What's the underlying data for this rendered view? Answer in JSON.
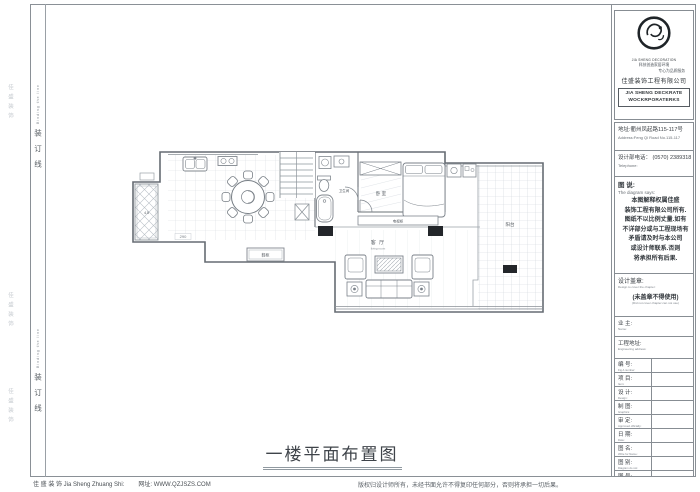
{
  "sheet": {
    "drawing_title": "一楼平面布置图"
  },
  "binding": {
    "cn": "装订线",
    "en": "Binding the line"
  },
  "side_marks": {
    "m1": "佳盛装饰",
    "m2": "佳盛装饰",
    "m3": "佳盛装饰"
  },
  "title_block": {
    "logo": {
      "caption": "JIA SHENG DECORATION",
      "slogan1": "科技创造家居环境",
      "slogan2": "专心为品质服务",
      "company": "佳盛装饰工程有限公司",
      "name_en1": "JIA SHENG DECKRATE",
      "name_en2": "WOCKRPORATERKS"
    },
    "address_cn": "地址:衢州凤起路115-117号",
    "address_en": "Address:Feng Qi Road No.115-117",
    "phone_cn": "设计部电话： (0570) 2389318",
    "phone_en": "Telephone:",
    "notes_cn": "图 说:",
    "notes_en": "The diagram says:",
    "notes_body": "本图解释权属佳盛\n装饰工程有限公司所有.\n图纸不以比例丈量.如有\n不详部分或与工程现场有\n矛盾请及时与本公司\n或设计师联系.否则\n将承担所有后果.",
    "seal_cn": "设计盖章:",
    "seal_en": "Design to cover the chapter:",
    "seal_warn_cn": "(未盖章不得使用)",
    "seal_warn_en": "(Did not cover chapter can not use)",
    "owner_cn": "业 主:",
    "owner_en": "Name:",
    "site_cn": "工程地址:",
    "site_en": "Engineering address:",
    "rows": [
      {
        "cn": "编 号:",
        "en": "Fig A number:"
      },
      {
        "cn": "项 目:",
        "en": "Item:"
      },
      {
        "cn": "设 计:",
        "en": "Design:"
      },
      {
        "cn": "制 图:",
        "en": "Graphics:"
      },
      {
        "cn": "审 定:",
        "en": "Approved officially:"
      },
      {
        "cn": "日 期:",
        "en": "Date:"
      },
      {
        "cn": "图 名:",
        "en": "Write for Name:"
      },
      {
        "cn": "图 别:",
        "en": "Diagram do not:"
      },
      {
        "cn": "图 号:",
        "en": "Diagram number:"
      }
    ]
  },
  "plan_labels": {
    "living": "客 厅",
    "living_sub": "living room",
    "bedroom": "卧 室",
    "bathroom": "卫生间",
    "terrace": "阳台",
    "shoe_cabinet": "鞋柜",
    "tv_cabinet": "电视柜",
    "balcony_area": "4.5",
    "dim": "290"
  },
  "footer": {
    "company": "佳 盛 装 饰 Jia Sheng Zhuang Shi:",
    "website": "网址: WWW.QZJSZS.COM",
    "copyright": "版权归设计师所有，未经书面允许不得复印任何部分，否则将承担一切后果。"
  }
}
